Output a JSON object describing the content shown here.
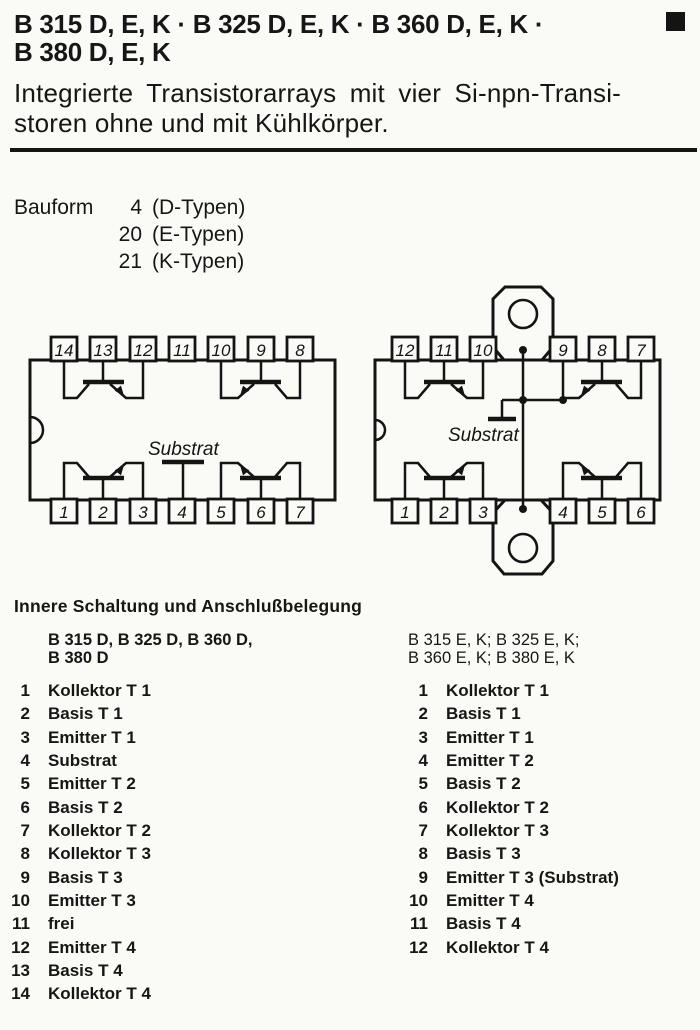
{
  "page": {
    "title_line1": "B 315 D, E, K · B 325 D, E, K · B 360 D, E, K ·",
    "title_line2": "B 380 D, E, K",
    "subtitle_line1": "Integrierte Transistorarrays mit vier Si-npn-Transi-",
    "subtitle_line2": "storen ohne und mit Kühlkörper.",
    "corner_mark_icon": "black-square"
  },
  "bauform": {
    "label": "Bauform",
    "rows": [
      {
        "num": "4",
        "type": "(D-Typen)"
      },
      {
        "num": "20",
        "type": "(E-Typen)"
      },
      {
        "num": "21",
        "type": "(K-Typen)"
      }
    ]
  },
  "diagrams": {
    "dip14": {
      "top_pins": [
        "14",
        "13",
        "12",
        "11",
        "10",
        "9",
        "8"
      ],
      "bottom_pins": [
        "1",
        "2",
        "3",
        "4",
        "5",
        "6",
        "7"
      ],
      "substrat_label": "Substrat"
    },
    "dip12k": {
      "top_pins": [
        "12",
        "11",
        "10",
        "9",
        "8",
        "7"
      ],
      "bottom_pins": [
        "1",
        "2",
        "3",
        "4",
        "5",
        "6"
      ],
      "substrat_label": "Substrat"
    }
  },
  "pinout": {
    "heading": "Innere Schaltung und Anschlußbelegung",
    "left": {
      "header_line1": "B 315 D, B 325 D, B 360 D,",
      "header_line2": "B 380 D",
      "pins": [
        {
          "n": "1",
          "t": "Kollektor T 1"
        },
        {
          "n": "2",
          "t": "Basis T 1"
        },
        {
          "n": "3",
          "t": "Emitter T 1"
        },
        {
          "n": "4",
          "t": "Substrat"
        },
        {
          "n": "5",
          "t": "Emitter T 2"
        },
        {
          "n": "6",
          "t": "Basis T 2"
        },
        {
          "n": "7",
          "t": "Kollektor T 2"
        },
        {
          "n": "8",
          "t": "Kollektor T 3"
        },
        {
          "n": "9",
          "t": "Basis T 3"
        },
        {
          "n": "10",
          "t": "Emitter T 3"
        },
        {
          "n": "11",
          "t": "frei"
        },
        {
          "n": "12",
          "t": "Emitter T 4"
        },
        {
          "n": "13",
          "t": "Basis T 4"
        },
        {
          "n": "14",
          "t": "Kollektor T 4"
        }
      ]
    },
    "right": {
      "header_line1": "B 315 E, K; B 325 E, K;",
      "header_line2": "B 360 E, K; B 380 E, K",
      "pins": [
        {
          "n": "1",
          "t": "Kollektor T 1"
        },
        {
          "n": "2",
          "t": "Basis T 1"
        },
        {
          "n": "3",
          "t": "Emitter T 1"
        },
        {
          "n": "4",
          "t": "Emitter T 2"
        },
        {
          "n": "5",
          "t": "Basis T 2"
        },
        {
          "n": "6",
          "t": "Kollektor T 2"
        },
        {
          "n": "7",
          "t": "Kollektor T 3"
        },
        {
          "n": "8",
          "t": "Basis T 3"
        },
        {
          "n": "9",
          "t": "Emitter T 3 (Substrat)"
        },
        {
          "n": "10",
          "t": "Emitter T 4"
        },
        {
          "n": "11",
          "t": "Basis T 4"
        },
        {
          "n": "12",
          "t": "Kollektor T 4"
        }
      ]
    }
  }
}
